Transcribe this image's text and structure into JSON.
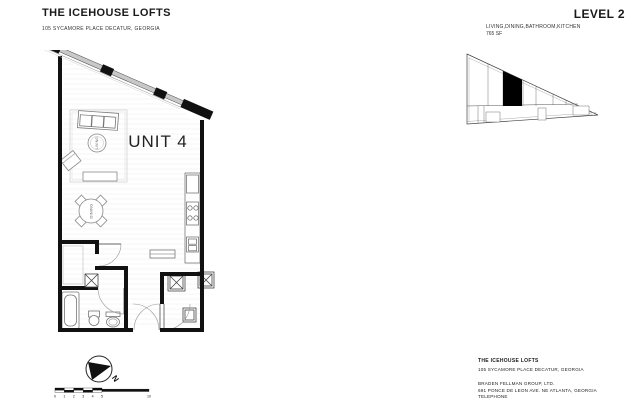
{
  "sheet": {
    "project_title": "THE ICEHOUSE LOFTS",
    "project_address": "105 SYCAMORE PLACE DECATUR, GEORGIA",
    "level_title": "LEVEL 2",
    "level_rooms": "LIVING,DINING,BATHROOM,KITCHEN",
    "level_area": "765 SF"
  },
  "floor_plan": {
    "unit_label": "UNIT 4",
    "living_label": "LIVING",
    "dining_label": "DINING"
  },
  "compass": {
    "north_label": "N"
  },
  "scale_bar": {
    "ticks": [
      "0",
      "1",
      "2",
      "3",
      "4",
      "5"
    ],
    "end_label": "10"
  },
  "title_block": {
    "project": "THE ICEHOUSE LOFTS",
    "project_address": "105 SYCAMORE PLACE DECATUR, GEORGIA",
    "company": "BRADEN FELLMAN GROUP, LTD.",
    "company_address": "691 PONCE DE LEON AVE. NE ATLANTA, GEORGIA",
    "company_phone": "TELEPHONE"
  },
  "colors": {
    "paper": "#ffffff",
    "wall": "#111111",
    "line": "#555555",
    "glass": "#c8c8c8"
  }
}
